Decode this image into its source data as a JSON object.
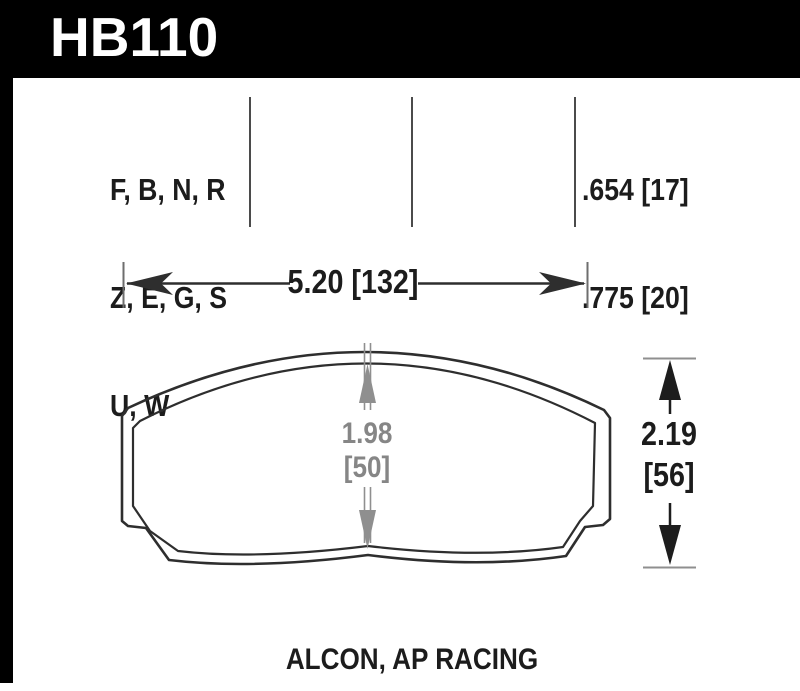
{
  "header": {
    "part_number": "HB110"
  },
  "columns": {
    "compound_codes": [
      "F, B, N, R",
      "Z, E, G, S",
      "U, W"
    ],
    "thickness_values": [
      ".654 [17]",
      ".775 [20]"
    ]
  },
  "dimensions": {
    "width": "5.20 [132]",
    "pad_height_center": {
      "inches": "1.98",
      "mm": "[50]"
    },
    "overall_height": {
      "inches": "2.19",
      "mm": "[56]"
    }
  },
  "footer": {
    "applications": "ALCON, AP RACING"
  },
  "colors": {
    "header_bg": "#000000",
    "outline": "#2e2e2e",
    "dim_gray": "#8a8a8a",
    "text": "#1c1c1c"
  }
}
